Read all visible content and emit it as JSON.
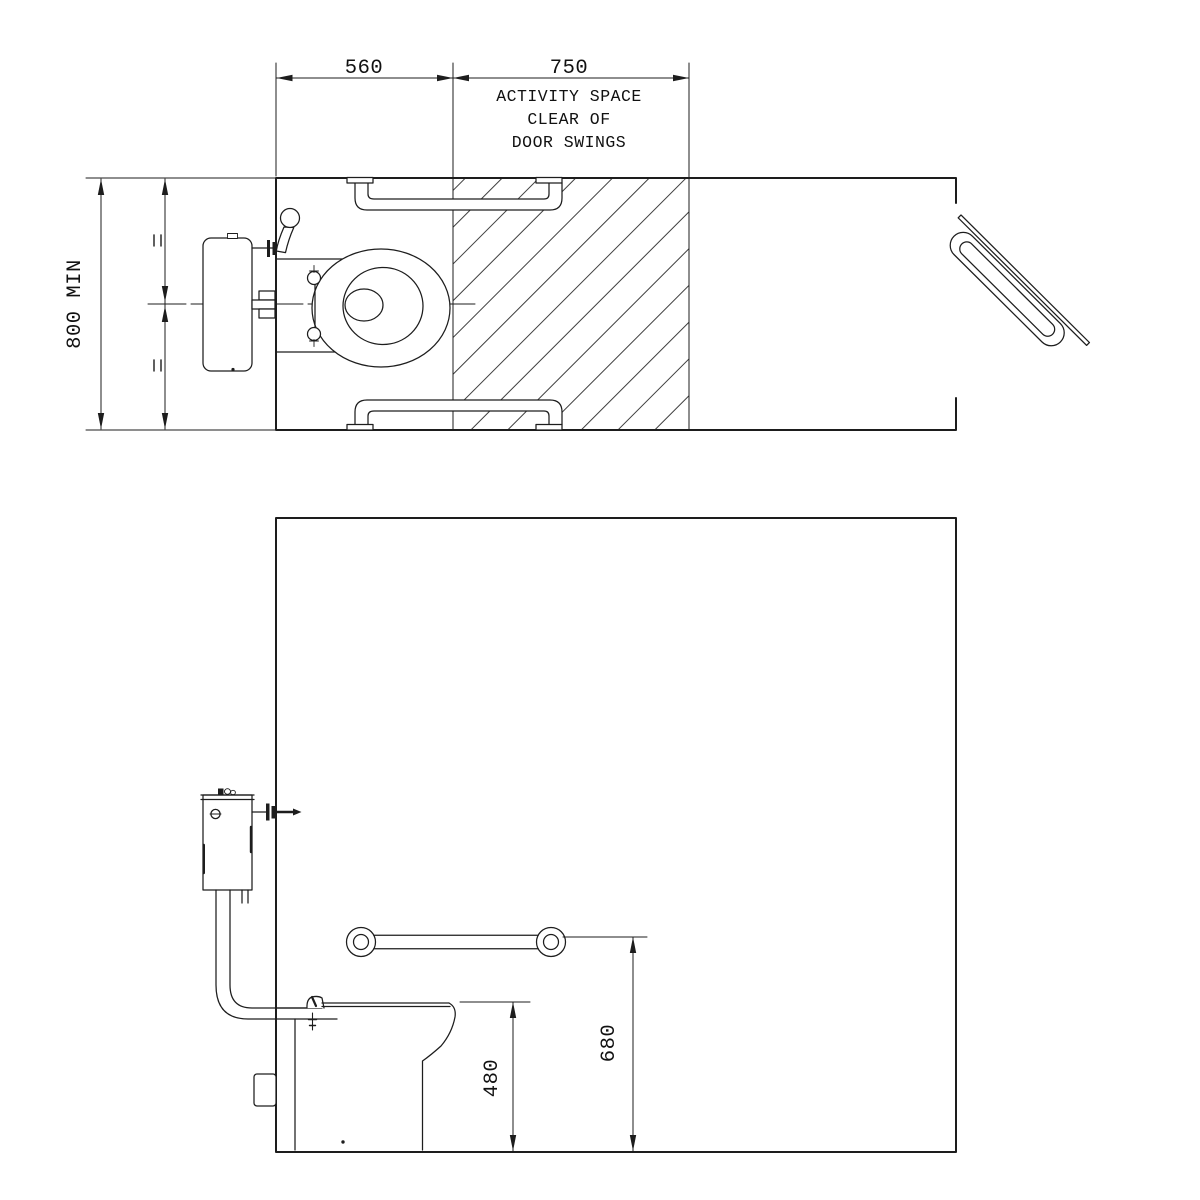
{
  "plan": {
    "dim_left": "560",
    "dim_right": "750",
    "note": [
      "ACTIVITY SPACE",
      "CLEAR OF",
      "DOOR SWINGS"
    ],
    "dim_depth": "800 MIN"
  },
  "elevation": {
    "dim_seat_height": "480",
    "dim_rail_height": "680"
  },
  "colors": {
    "line": "#1d1d1d",
    "hatch": "#3f3f3f",
    "background": "#ffffff"
  }
}
